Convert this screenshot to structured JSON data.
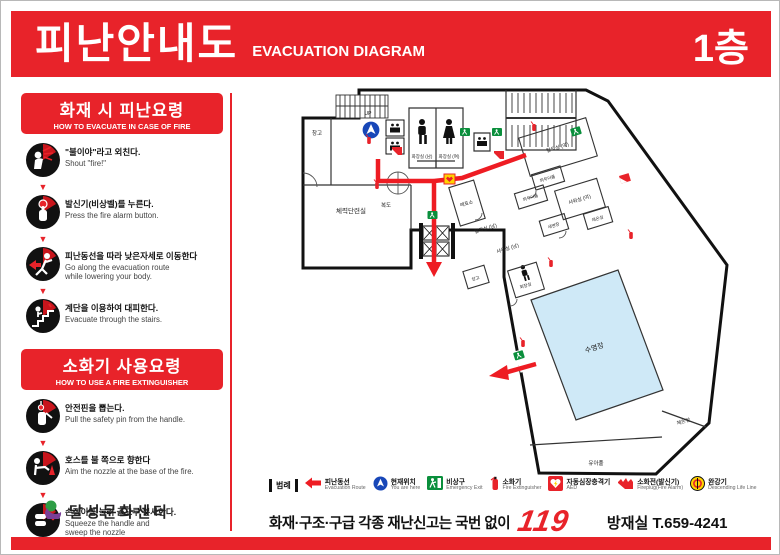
{
  "header": {
    "title_ko": "피난안내도",
    "title_en": "EVACUATION DIAGRAM",
    "floor": "1층"
  },
  "sidebar": {
    "evacuation": {
      "title_ko": "화재 시 피난요령",
      "title_en": "HOW TO EVACUATE IN CASE OF FIRE",
      "steps": [
        {
          "ko": "\"불이야\"라고 외친다.",
          "en": "Shout \"fire!\"",
          "icon": "shout-fire-icon"
        },
        {
          "ko": "발신기(비상벨)를 누른다.",
          "en": "Press the fire alarm button.",
          "icon": "press-alarm-icon"
        },
        {
          "ko": "피난동선을 따라 낮은자세로 이동한다",
          "en": "Go along the evacuation route\nwhile lowering your body.",
          "icon": "crouch-run-icon"
        },
        {
          "ko": "계단을 이용하여 대피한다.",
          "en": "Evacuate through the stairs.",
          "icon": "stairs-icon"
        }
      ]
    },
    "extinguisher": {
      "title_ko": "소화기 사용요령",
      "title_en": "HOW TO USE A FIRE EXTINGUISHER",
      "steps": [
        {
          "ko": "안전핀을 뽑는다.",
          "en": "Pull the safety pin from the handle.",
          "icon": "safety-pin-icon"
        },
        {
          "ko": "호스를 불 쪽으로 향한다",
          "en": "Aim the nozzle at the base of the fire.",
          "icon": "aim-nozzle-icon"
        },
        {
          "ko": "손잡이를 눌러 골고루 분사한다.",
          "en": "Squeeze the handle and\nsweep the nozzle\nfrom side to side.",
          "icon": "squeeze-handle-icon"
        }
      ]
    },
    "logo_text": "달성문화센터"
  },
  "floorplan": {
    "labels": {
      "storage_left": "창고",
      "stairs_up": "UP",
      "fitness": "체력단련실",
      "corridor": "복도",
      "toilet_m": "화장실 (남)",
      "toilet_w": "화장실 (여)",
      "ticket": "매표소",
      "locker_w": "탈의실 (여)",
      "locker_m": "탈의실 (남)",
      "powder1": "파우더룸",
      "powder2": "파우더룸",
      "shower_w": "샤워실 (여)",
      "shower_m": "샤워실 (남)",
      "washroom": "세면장",
      "warm_room": "체온실",
      "storage_wing": "창고",
      "toilet_wing": "화장실",
      "pool": "수영장",
      "kids_pool": "유아풀",
      "warm_bath": "체온탕"
    }
  },
  "legend": {
    "label": "범례",
    "items": [
      {
        "ko": "피난동선",
        "en": "Evacuation Route",
        "icon": "evacuation-route-icon"
      },
      {
        "ko": "현재위치",
        "en": "You are here",
        "icon": "current-location-icon"
      },
      {
        "ko": "비상구",
        "en": "Emergency Exit",
        "icon": "emergency-exit-icon"
      },
      {
        "ko": "소화기",
        "en": "Fire Extinguisher",
        "icon": "fire-extinguisher-icon"
      },
      {
        "ko": "자동심장충격기",
        "en": "AED",
        "icon": "aed-icon"
      },
      {
        "ko": "소화전(발신기)",
        "en": "Fireplug(Fire Alarm)",
        "icon": "fireplug-icon"
      },
      {
        "ko": "완강기",
        "en": "Descending Life Line",
        "icon": "descending-life-line-icon"
      }
    ]
  },
  "footer": {
    "report": "화재·구조·구급 각종 재난신고는 국번 없이",
    "number": "119",
    "office": "방재실 T.659-4241"
  },
  "colors": {
    "accent_red": "#e8232a",
    "route_red": "#ee1c23",
    "pool_blue": "#cfe9f7",
    "exit_green": "#0a8f3c",
    "location_blue": "#1847b8",
    "aed_yellow": "#ffd400"
  }
}
